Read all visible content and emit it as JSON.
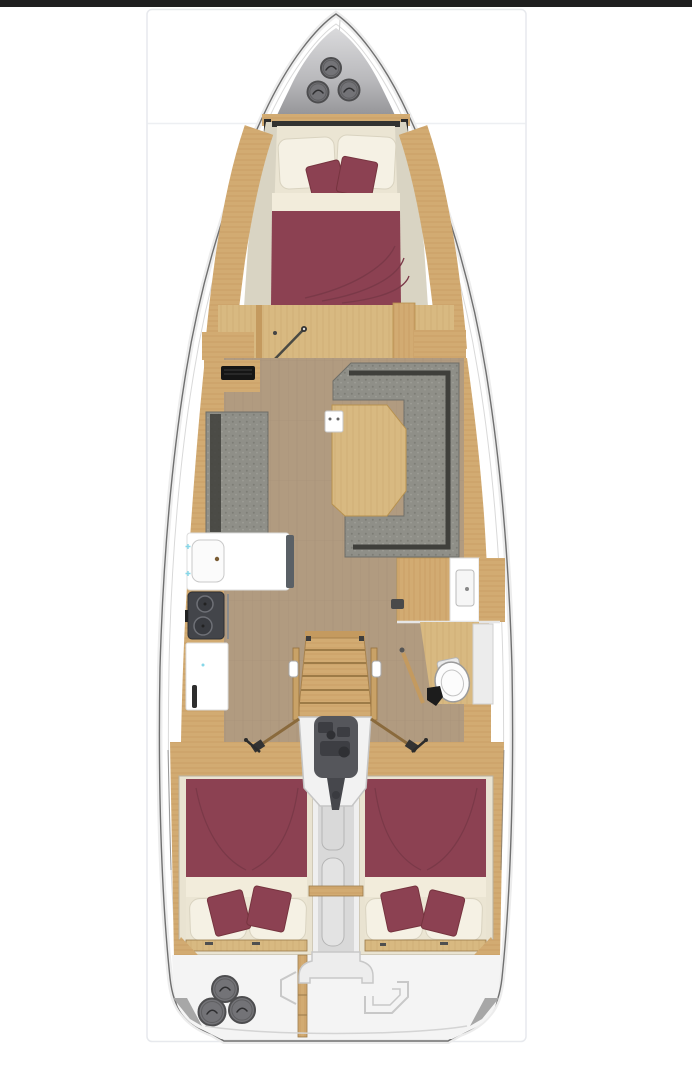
{
  "page": {
    "kind": "yacht-layout-viewer",
    "visible_text": "none",
    "top_bar": {
      "present": true,
      "color": "#1f1f1f"
    },
    "card": {
      "border_color": "#e7e9ed",
      "background": "#ffffff",
      "separator_color": "#edeff2"
    }
  },
  "colors": {
    "topbar": "#1f1f1f",
    "card_bg": "#ffffff",
    "card_border": "#e7e9ed",
    "separator": "#edeff2",
    "hull_fill": "#ffffff",
    "hull_stroke": "#707070",
    "hull_inner": "#d9d9d9",
    "hull_shade": "#ececec",
    "deck1": "#d6d6d8",
    "deck2": "#8e8e91",
    "hatch": "#737377",
    "hatch_ring": "#4d4d4f",
    "hatch_mark": "#2e2e30",
    "wood": "#d2ab72",
    "wood_line": "#bf9459",
    "wood_dark": "#c49a5f",
    "wood_edge": "#9a7a4a",
    "wood_pale": "#d8b981",
    "wood_pale_line": "#c8a468",
    "floor": "#b19b80",
    "floor_line": "#a68f74",
    "beige": "#d9d4c3",
    "cream": "#ebe5d3",
    "pillow": "#f5f1e4",
    "pillow_line": "#d9d3c0",
    "sheet": "#f2ecdb",
    "maroon": "#8c4152",
    "maroon_line": "#7a3948",
    "maroon_dark": "#76343f",
    "sofa": "#8f8f88",
    "sofa_dot": "#7d7d76",
    "sofa_dark": "#3f3f3b",
    "sofa_edge": "#6e6e67",
    "fixture": "#ffffff",
    "fixture_line": "#c7c7c7",
    "slate": "#5a6066",
    "stove": "#43454a",
    "stove_line": "#2e3034",
    "burner": "#393b40",
    "burner_ring": "#6e7076",
    "engine": "#55565b",
    "engine_dark": "#3c3d42",
    "bay": "#f2f2f2",
    "bay_line": "#c5c5c5",
    "corridor": "#d9d9d9",
    "corridor_lt": "#efefef",
    "corridor_line": "#b5b5b5",
    "stern": "#f4f4f4",
    "stern_line": "#c8c8c8",
    "wedge": "#a7a7a7",
    "rod": "#8a6a3c",
    "cyan": "#86d7e8"
  },
  "floorplan": {
    "type": "sailing-yacht-deck-plan",
    "orientation": "bow-up",
    "areas": [
      "bow-deck",
      "forward-cabin-v-berth",
      "forward-vestibule",
      "salon",
      "nav-vent",
      "port-bench",
      "u-shaped-sofa",
      "salon-table",
      "galley",
      "head-with-toilet",
      "companionway-stairs",
      "engine-compartment",
      "aft-cabin-port",
      "aft-cabin-starboard",
      "stern-transom"
    ],
    "berths": {
      "double_beds": 3,
      "decor_cushions_per_bed": 2
    },
    "bow_hatches": [
      {
        "cx": 331,
        "cy": 68,
        "r": 10
      },
      {
        "cx": 318,
        "cy": 92,
        "r": 10.5
      },
      {
        "cx": 349,
        "cy": 90,
        "r": 10.5
      }
    ],
    "stern_hatches": [
      {
        "cx": 225,
        "cy": 989,
        "r": 13
      },
      {
        "cx": 212,
        "cy": 1012,
        "r": 13.5
      },
      {
        "cx": 242,
        "cy": 1010,
        "r": 13
      }
    ]
  }
}
